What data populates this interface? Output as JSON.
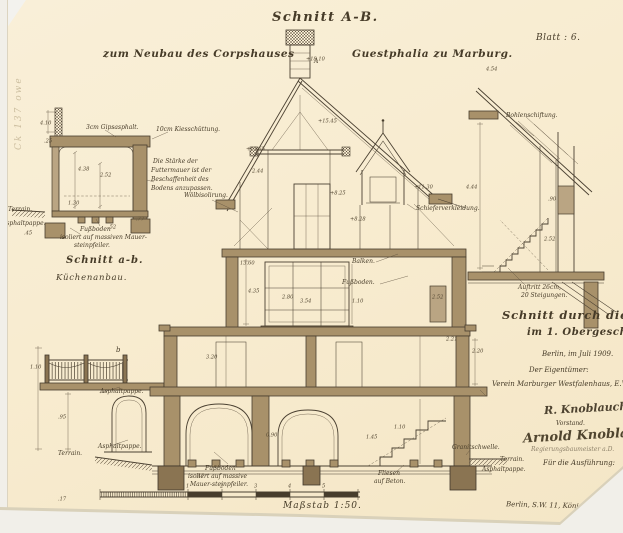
{
  "paper": {
    "background": "#f8ecd0",
    "ink": "#463b28",
    "wall_fill": "#a8916a"
  },
  "stamp": "Ck 137 owe",
  "header": {
    "title": "Schnitt A-B.",
    "subtitle_left": "zum Neubau des Corpshauses",
    "subtitle_right": "Guestphalia zu Marburg.",
    "sheet": "Blatt : 6."
  },
  "kitchen_detail": {
    "heading": "Schnitt a-b.",
    "subheading": "Küchenanbau.",
    "label_gipsasphalt": "3cm Gipsasphalt.",
    "label_kies": "10cm Kiesschüttung.",
    "note_futtermauer_1": "Die Stärke der",
    "note_futtermauer_2": "Futtermauer ist der",
    "note_futtermauer_3": "Beschaffenheit des",
    "note_futtermauer_4": "Bodens anzupassen.",
    "label_terrain": "Terrain.",
    "label_asphaltpappe": "Asphaltpappe.",
    "note_fussboden_1": "Fußboden",
    "note_fussboden_2": "isoliert auf massiven Mauer-",
    "note_fussboden_3": "steinpfeiler."
  },
  "main_section": {
    "marker_a": "A",
    "marker_b": "b",
    "label_woelbisolirung": "Wölbisolirung.",
    "label_schiefer": "Schieferverkleidung.",
    "label_balken": "Balken.",
    "label_fussboden": "Fußboden.",
    "label_asphaltpappe_top": "Asphaltpappe.",
    "label_asphaltpappe_arch": "Asphaltpappe.",
    "label_terrain_left": "Terrain.",
    "note_fussboden_1": "Fußboden",
    "note_fussboden_2": "isoliert auf massive",
    "note_fussboden_3": "Mauer-steinpfeiler.",
    "label_fliesen_1": "Fliesen",
    "label_fliesen_2": "auf Beton.",
    "label_granitschwelle": "Granitschwelle.",
    "label_terrain_right": "Terrain.",
    "label_asphaltpappe_right": "Asphaltpappe."
  },
  "stair_detail": {
    "label_bohlenschiftung": "Bohlenschiftung.",
    "label_auftritt_1": "Auftritt 26cm,",
    "label_auftritt_2": "20 Steigungen.",
    "heading_1": "Schnitt durch die Treppe",
    "heading_2": "im 1. Obergeschoss."
  },
  "title_block": {
    "date": "Berlin, im Juli 1909.",
    "owner_label": "Der Eigentümer:",
    "owner_name": "Verein Marburger Westfalenhaus, E.V.",
    "signature_1": "R. Knoblauch",
    "signature_1_role": "Vorstand.",
    "signature_2": "Arnold Knoblauch",
    "signature_2_role": "Regierungsbaumeister a.D.",
    "execution_label": "Für die Ausführung:",
    "address": "Berlin, S.W. 11, Königgrätzerstrasse."
  },
  "footer": {
    "scale": "Maßstab 1:50."
  },
  "dimensions": [
    {
      "t": "4.10",
      "x": 40,
      "y": 120
    },
    {
      "t": ".25",
      "x": 44,
      "y": 138
    },
    {
      "t": "4.38",
      "x": 78,
      "y": 166
    },
    {
      "t": "2.52",
      "x": 100,
      "y": 172
    },
    {
      "t": "1.30",
      "x": 68,
      "y": 200
    },
    {
      "t": ".77",
      "x": 136,
      "y": 216
    },
    {
      "t": ".45",
      "x": 24,
      "y": 230
    },
    {
      "t": ".52",
      "x": 108,
      "y": 224
    },
    {
      "t": "+18.10",
      "x": 306,
      "y": 56
    },
    {
      "t": "+15.45",
      "x": 318,
      "y": 118
    },
    {
      "t": "+13.65",
      "x": 246,
      "y": 146
    },
    {
      "t": "+11.30",
      "x": 414,
      "y": 184
    },
    {
      "t": "+8.25",
      "x": 330,
      "y": 190
    },
    {
      "t": "+8.28",
      "x": 350,
      "y": 216
    },
    {
      "t": "13.60",
      "x": 240,
      "y": 260
    },
    {
      "t": "2.44",
      "x": 252,
      "y": 168
    },
    {
      "t": "4.35",
      "x": 248,
      "y": 288
    },
    {
      "t": "2.80",
      "x": 282,
      "y": 294
    },
    {
      "t": "3.54",
      "x": 300,
      "y": 298
    },
    {
      "t": "2.52",
      "x": 432,
      "y": 294
    },
    {
      "t": "3.20",
      "x": 206,
      "y": 354
    },
    {
      "t": "1.10",
      "x": 352,
      "y": 298
    },
    {
      "t": "2.20",
      "x": 472,
      "y": 348
    },
    {
      "t": "0.90",
      "x": 266,
      "y": 432
    },
    {
      "t": "1.45",
      "x": 366,
      "y": 434
    },
    {
      "t": "1.10",
      "x": 394,
      "y": 424
    },
    {
      "t": ".47",
      "x": 196,
      "y": 473
    },
    {
      "t": "2.21",
      "x": 446,
      "y": 336
    },
    {
      "t": "4.44",
      "x": 466,
      "y": 184
    },
    {
      "t": "2.52",
      "x": 544,
      "y": 236
    },
    {
      "t": ".90",
      "x": 548,
      "y": 196
    },
    {
      "t": "4.54",
      "x": 486,
      "y": 66
    },
    {
      "t": "1.10",
      "x": 30,
      "y": 364
    },
    {
      "t": ".95",
      "x": 58,
      "y": 414
    },
    {
      "t": ".17",
      "x": 58,
      "y": 496
    },
    {
      "t": "1",
      "x": 186,
      "y": 483
    },
    {
      "t": "2",
      "x": 220,
      "y": 483
    },
    {
      "t": "3",
      "x": 254,
      "y": 483
    },
    {
      "t": "4",
      "x": 288,
      "y": 483
    },
    {
      "t": "5",
      "x": 322,
      "y": 483
    }
  ]
}
